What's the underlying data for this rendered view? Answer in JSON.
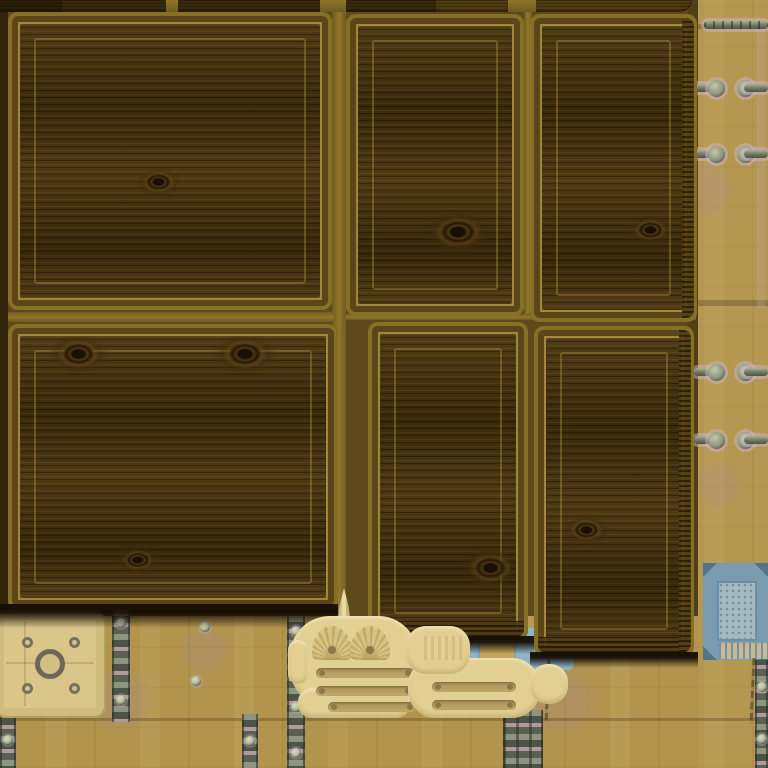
{
  "scene": {
    "type": "top-down game view",
    "setting": "wooden storage crates on a riveted wooden plank floor",
    "canvas": {
      "w": 768,
      "h": 768
    }
  },
  "palette": {
    "floor": "#b2944d",
    "floor_light": "#c4a65c",
    "floor_dark": "#9d8343",
    "bed": "#5e491c",
    "bed_edge": "#33240c",
    "gap_light": "#8f7529",
    "crate_edge": "#857026",
    "crate_bevel": "#6b5520",
    "crate_bevel_dark": "#5b4619",
    "wood": "#46330f",
    "wood_dark": "#2f2109",
    "wood_light": "#564013",
    "frame_line": "rgba(176,148,66,0.8)",
    "top_dark": "#38280c",
    "top_darker": "#2c1f08",
    "top_mid": "#4e3a11",
    "shadow": "#1a1206",
    "cream": "#e2cf92",
    "cream_shade": "#c9b274",
    "slot": "#b89f61",
    "slot_dot": "#8b7747",
    "plate": "#d9c688",
    "plate_line": "#a89360",
    "ring": "#6b675a",
    "metal_light": "#8d9480",
    "metal_dark": "#4d5345",
    "metal_pink": "#b09a9e",
    "rivet_face": "#b9c0a4",
    "rivet_ring": "#4c5243",
    "halo": "rgba(205,180,200,0.5)",
    "blue_frame": "#7b9cb0",
    "blue_corner": "#54748c",
    "blue_inner": "#a4bac0",
    "comb_blue": "#6f93a8",
    "comb_tan": "#c9ba8d",
    "patch_blue": "#8fb3c9",
    "patch_tan": "#c5a75c",
    "mauve": "rgba(168,138,148,0.25)"
  },
  "bed": {
    "x": 0,
    "y": 0,
    "w": 698,
    "h": 616,
    "edge": {
      "x": 0,
      "y": 0,
      "w": 8,
      "h": 612
    },
    "right_shade": {
      "x": 688,
      "y": 0,
      "w": 10,
      "h": 616
    },
    "gap_lines": [
      {
        "x": 332,
        "y": 0,
        "w": 14,
        "h": 612,
        "o": "v"
      },
      {
        "x": 524,
        "y": 0,
        "w": 8,
        "h": 320,
        "o": "v"
      },
      {
        "x": 8,
        "y": 312,
        "w": 326,
        "h": 10,
        "o": "h"
      },
      {
        "x": 346,
        "y": 314,
        "w": 350,
        "h": 6,
        "o": "h"
      }
    ]
  },
  "top_row": {
    "h": 12,
    "segments": [
      {
        "x": 0,
        "w": 62,
        "shade": "darker"
      },
      {
        "x": 62,
        "w": 104,
        "shade": "dark"
      },
      {
        "x": 166,
        "w": 12,
        "shade": "gap"
      },
      {
        "x": 178,
        "w": 142,
        "shade": "dark"
      },
      {
        "x": 320,
        "w": 26,
        "shade": "gap"
      },
      {
        "x": 346,
        "w": 90,
        "shade": "dark"
      },
      {
        "x": 436,
        "w": 72,
        "shade": "mid"
      },
      {
        "x": 508,
        "w": 28,
        "shade": "gap"
      },
      {
        "x": 536,
        "w": 156,
        "shade": "mid",
        "rounded": true
      }
    ]
  },
  "crates": [
    {
      "id": "crate-1",
      "x": 8,
      "y": 12,
      "w": 324,
      "h": 298,
      "knots": [
        {
          "x": 150,
          "y": 170,
          "s": 0.7
        }
      ]
    },
    {
      "id": "crate-2",
      "x": 346,
      "y": 14,
      "w": 178,
      "h": 302,
      "knots": [
        {
          "x": 112,
          "y": 218,
          "s": 1.0
        }
      ]
    },
    {
      "id": "crate-3",
      "x": 530,
      "y": 14,
      "w": 167,
      "h": 308,
      "knots": [
        {
          "x": 120,
          "y": 216,
          "s": 0.7
        }
      ],
      "ribR": true
    },
    {
      "id": "crate-4",
      "x": 8,
      "y": 324,
      "w": 330,
      "h": 286,
      "knots": [
        {
          "x": 70,
          "y": 30,
          "s": 0.9
        },
        {
          "x": 237,
          "y": 30,
          "s": 0.95
        },
        {
          "x": 130,
          "y": 236,
          "s": 0.65
        }
      ]
    },
    {
      "id": "crate-5",
      "x": 368,
      "y": 322,
      "w": 160,
      "h": 318,
      "knots": [
        {
          "x": 122,
          "y": 246,
          "s": 0.9
        }
      ],
      "ribB": true
    },
    {
      "id": "crate-6",
      "x": 534,
      "y": 326,
      "w": 160,
      "h": 330,
      "knots": [
        {
          "x": 52,
          "y": 204,
          "s": 0.7
        }
      ],
      "ribB": true,
      "ribR": true
    }
  ],
  "shadows": [
    {
      "x": 0,
      "y": 604,
      "w": 338,
      "h": 24
    },
    {
      "x": 362,
      "y": 636,
      "w": 172,
      "h": 18
    },
    {
      "x": 530,
      "y": 652,
      "w": 168,
      "h": 16
    }
  ],
  "floor": {
    "seams": [
      {
        "x": 0,
        "y": 718,
        "w": 768,
        "h": 3
      },
      {
        "x": 692,
        "y": 300,
        "w": 76,
        "h": 6
      },
      {
        "x": 692,
        "y": 24,
        "w": 76,
        "h": 5
      }
    ],
    "right_light": {
      "x": 698,
      "y": 0,
      "w": 70,
      "h": 768
    },
    "lavender_line": {
      "x": 757,
      "y": 28,
      "w": 8,
      "h": 280
    },
    "mauve": [
      {
        "x": 120,
        "y": 700,
        "r": 34
      },
      {
        "x": 562,
        "y": 700,
        "r": 38
      },
      {
        "x": 205,
        "y": 650,
        "r": 26
      },
      {
        "x": 706,
        "y": 190,
        "r": 30
      },
      {
        "x": 718,
        "y": 486,
        "r": 26
      }
    ],
    "cracks": [
      {
        "x": 546,
        "y": 658,
        "h": 64
      },
      {
        "x": 751,
        "y": 658,
        "h": 66
      }
    ],
    "rivets": [
      {
        "x": 205,
        "y": 627
      },
      {
        "x": 196,
        "y": 681
      },
      {
        "x": 548,
        "y": 656
      }
    ],
    "top_rod": {
      "x": 704,
      "y": 21,
      "w": 64,
      "h": 8
    }
  },
  "pins": {
    "rows": [
      88,
      154,
      372,
      440
    ],
    "left_rod": {
      "x": 694,
      "w": 26
    },
    "left_cap_x": 708,
    "right_cap_x": 737,
    "right_rod": {
      "x": 744,
      "w": 24
    }
  },
  "strips": [
    {
      "x": 112,
      "y": 610,
      "w": 18,
      "h": 112,
      "rivets": [
        0.12,
        0.8
      ]
    },
    {
      "x": 287,
      "y": 616,
      "w": 18,
      "h": 152,
      "rivets": [
        0.1,
        0.6,
        0.9
      ]
    },
    {
      "x": 503,
      "y": 710,
      "w": 40,
      "h": 58,
      "wide": true,
      "rivets": []
    },
    {
      "x": 0,
      "y": 712,
      "w": 16,
      "h": 56,
      "rivets": [
        0.5
      ]
    },
    {
      "x": 242,
      "y": 714,
      "w": 16,
      "h": 54,
      "rivets": [
        0.5
      ]
    },
    {
      "x": 755,
      "y": 652,
      "w": 13,
      "h": 116,
      "rivets": [
        0.3,
        0.75
      ]
    }
  ],
  "hatch_plate": {
    "x": -6,
    "y": 610,
    "w": 112,
    "h": 108,
    "ring": {
      "x": 56,
      "y": 54,
      "r": 15
    },
    "rivets": [
      [
        33,
        32
      ],
      [
        80,
        32
      ],
      [
        33,
        78
      ],
      [
        80,
        78
      ]
    ],
    "lines": [
      {
        "x": 30,
        "y": 12,
        "w": 2,
        "h": 84
      },
      {
        "x": 12,
        "y": 52,
        "w": 88,
        "h": 2
      }
    ]
  },
  "blue_plate": {
    "x": 703,
    "y": 563,
    "w": 65,
    "h": 97,
    "inner": {
      "x": 14,
      "y": 18,
      "w": 40,
      "h": 60
    },
    "comb": {
      "x": 16,
      "y": 80,
      "w": 49,
      "h": 16
    }
  },
  "blue_patch": {
    "x": 468,
    "y": 628,
    "w": 106,
    "h": 42,
    "inner": {
      "x": 10,
      "y": 8,
      "w": 38,
      "h": 28
    }
  },
  "decals": [
    {
      "id": "vent-decal-1",
      "blobs": [
        [
          290,
          616,
          128,
          92,
          40
        ],
        [
          298,
          688,
          112,
          30,
          14
        ],
        [
          288,
          640,
          20,
          44,
          10
        ]
      ],
      "spike": {
        "x": 327,
        "y": 588,
        "w": 34,
        "h": 46
      },
      "arches": [
        {
          "x": 312,
          "y": 626
        },
        {
          "x": 350,
          "y": 626
        }
      ],
      "slots": [
        [
          316,
          668,
          98
        ],
        [
          316,
          686,
          98
        ],
        [
          328,
          702,
          88
        ]
      ]
    },
    {
      "id": "vent-decal-2",
      "blobs": [
        [
          408,
          658,
          132,
          60,
          28
        ],
        [
          406,
          626,
          64,
          48,
          20
        ],
        [
          530,
          664,
          38,
          40,
          18
        ]
      ],
      "stripes": {
        "x": 424,
        "y": 636,
        "w": 40,
        "h": 24
      },
      "slots": [
        [
          432,
          682,
          84
        ],
        [
          432,
          700,
          84
        ]
      ]
    }
  ]
}
